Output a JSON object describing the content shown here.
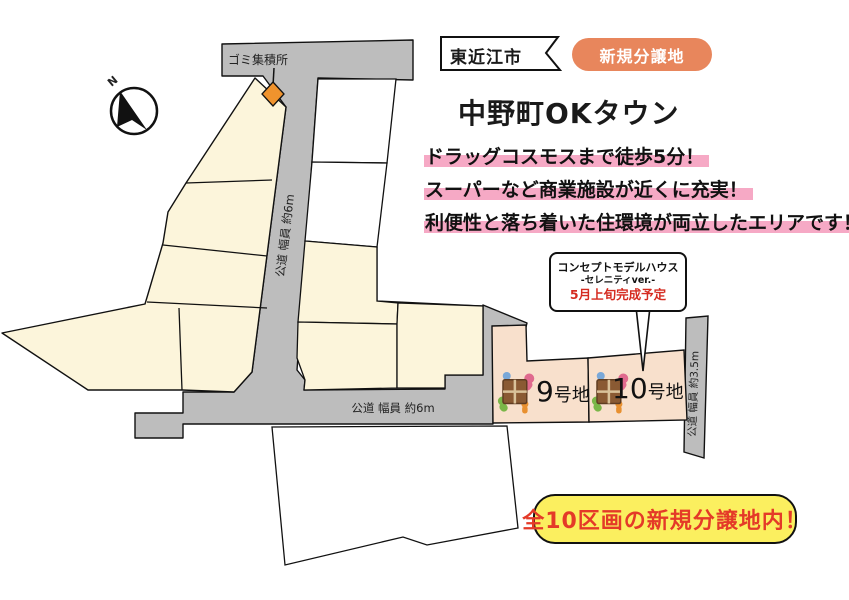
{
  "header": {
    "city_label": "東近江市",
    "new_badge": "新規分譲地",
    "title": "中野町OKタウン"
  },
  "highlights": {
    "line1": "ドラッグコスモスまで徒歩5分！",
    "line2": "スーパーなど商業施設が近くに充実！",
    "line3": "利便性と落ち着いた住環境が両立したエリアです！"
  },
  "callout": {
    "line1": "コンセプトモデルハウス",
    "line2": "-セレニティver.-",
    "line3": "5月上旬完成予定"
  },
  "map": {
    "compass_label": "N",
    "garbage_label": "ゴミ集積所",
    "road_center_label": "公道 幅員 約6m",
    "road_bottom_label": "公道 幅員 約6m",
    "road_right_label": "公道 幅員 約3.5m",
    "lot9": {
      "number": "9",
      "suffix": "号地"
    },
    "lot10": {
      "number": "10",
      "suffix": "号地"
    }
  },
  "footer": {
    "badge": "全10区画の新規分譲地内！"
  },
  "colors": {
    "road_gray": "#bdbdbd",
    "lot_cream": "#fcf5db",
    "lot_peach": "#f8e0cc",
    "marker_pink": "#f6a9c5",
    "badge_coral": "#e8865c",
    "badge_yellow": "#fbef5f",
    "accent_red": "#e43a28",
    "diamond_orange": "#f0932d"
  }
}
